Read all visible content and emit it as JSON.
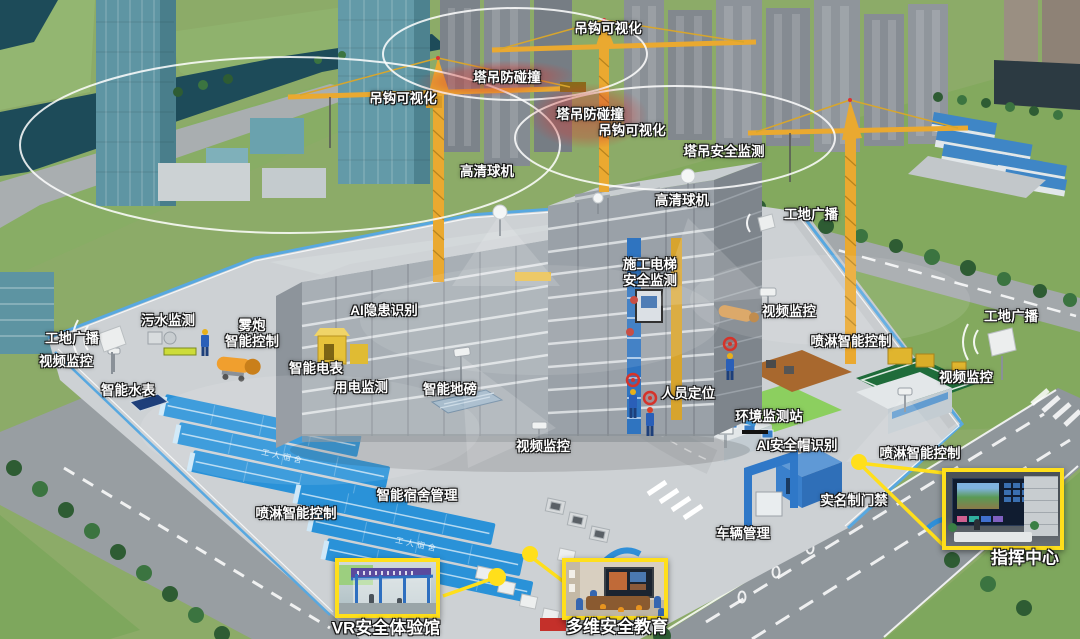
{
  "colors": {
    "accent_yellow": "#ffdf1b",
    "label_text": "#ffffff",
    "label_outline": "#141414",
    "collision_zone_red": "#d23c34",
    "fence_blue": "#58a8e0",
    "dorm_roof_blue": "#2a92d8",
    "crane_yellow": "#eaa930",
    "grass_green": "#8cab68",
    "road_gray": "#8f969b",
    "water_teal": "#1d4b59"
  },
  "roof_text": "工人宿舍",
  "labels": [
    {
      "id": "hook-visualization-top",
      "x": 608,
      "y": 29,
      "lines": [
        "吊钩可视化"
      ]
    },
    {
      "id": "tower-crane-anti-collision-1",
      "x": 507,
      "y": 78,
      "lines": [
        "塔吊防碰撞"
      ]
    },
    {
      "id": "hook-visualization-left",
      "x": 403,
      "y": 99,
      "lines": [
        "吊钩可视化"
      ]
    },
    {
      "id": "tower-crane-anti-collision-2",
      "x": 590,
      "y": 115,
      "lines": [
        "塔吊防碰撞"
      ]
    },
    {
      "id": "hook-visualization-mid",
      "x": 632,
      "y": 131,
      "lines": [
        "吊钩可视化"
      ]
    },
    {
      "id": "tower-crane-safety-monitoring",
      "x": 724,
      "y": 152,
      "lines": [
        "塔吊安全监测"
      ]
    },
    {
      "id": "hd-dome-camera-1",
      "x": 487,
      "y": 172,
      "lines": [
        "高清球机"
      ]
    },
    {
      "id": "hd-dome-camera-2",
      "x": 682,
      "y": 201,
      "lines": [
        "高清球机"
      ]
    },
    {
      "id": "site-broadcast-ne",
      "x": 811,
      "y": 215,
      "lines": [
        "工地广播"
      ]
    },
    {
      "id": "hoist-safety-monitoring",
      "x": 650,
      "y": 273,
      "lines": [
        "施工电梯",
        "安全监测"
      ]
    },
    {
      "id": "video-surveillance-ne",
      "x": 789,
      "y": 312,
      "lines": [
        "视频监控"
      ]
    },
    {
      "id": "site-broadcast-e",
      "x": 1011,
      "y": 317,
      "lines": [
        "工地广播"
      ]
    },
    {
      "id": "spray-smart-control-ne",
      "x": 851,
      "y": 342,
      "lines": [
        "喷淋智能控制"
      ]
    },
    {
      "id": "video-surveillance-e",
      "x": 966,
      "y": 378,
      "lines": [
        "视频监控"
      ]
    },
    {
      "id": "sewage-monitoring",
      "x": 168,
      "y": 321,
      "lines": [
        "污水监测"
      ]
    },
    {
      "id": "site-broadcast-w",
      "x": 72,
      "y": 339,
      "lines": [
        "工地广播"
      ]
    },
    {
      "id": "video-surveillance-w",
      "x": 66,
      "y": 362,
      "lines": [
        "视频监控"
      ]
    },
    {
      "id": "fog-cannon-smart-control",
      "x": 252,
      "y": 334,
      "lines": [
        "雾炮",
        "智能控制"
      ]
    },
    {
      "id": "ai-hazard-recognition",
      "x": 384,
      "y": 311,
      "lines": [
        "AI隐患识别"
      ]
    },
    {
      "id": "smart-electric-meter",
      "x": 316,
      "y": 369,
      "lines": [
        "智能电表"
      ]
    },
    {
      "id": "electricity-monitoring",
      "x": 361,
      "y": 388,
      "lines": [
        "用电监测"
      ]
    },
    {
      "id": "smart-water-meter",
      "x": 128,
      "y": 391,
      "lines": [
        "智能水表"
      ]
    },
    {
      "id": "smart-weighbridge",
      "x": 450,
      "y": 390,
      "lines": [
        "智能地磅"
      ]
    },
    {
      "id": "personnel-positioning",
      "x": 688,
      "y": 394,
      "lines": [
        "人员定位"
      ]
    },
    {
      "id": "environment-monitoring-station",
      "x": 769,
      "y": 417,
      "lines": [
        "环境监测站"
      ]
    },
    {
      "id": "ai-helmet-recognition",
      "x": 797,
      "y": 446,
      "lines": [
        "AI安全帽识别"
      ]
    },
    {
      "id": "spray-smart-control-e",
      "x": 920,
      "y": 454,
      "lines": [
        "喷淋智能控制"
      ]
    },
    {
      "id": "real-name-access-control",
      "x": 854,
      "y": 501,
      "lines": [
        "实名制门禁"
      ]
    },
    {
      "id": "video-surveillance-s",
      "x": 543,
      "y": 447,
      "lines": [
        "视频监控"
      ]
    },
    {
      "id": "smart-dormitory-management",
      "x": 417,
      "y": 496,
      "lines": [
        "智能宿舍管理"
      ]
    },
    {
      "id": "spray-smart-control-sw",
      "x": 296,
      "y": 514,
      "lines": [
        "喷淋智能控制"
      ]
    },
    {
      "id": "vehicle-management",
      "x": 743,
      "y": 534,
      "lines": [
        "车辆管理"
      ]
    }
  ],
  "insets": [
    {
      "id": "vr-safety-experience-hall",
      "caption": "VR安全体验馆",
      "box": {
        "x": 335,
        "y": 558,
        "w": 105,
        "h": 60
      },
      "caption_pos": {
        "x": 386,
        "y": 626
      }
    },
    {
      "id": "multi-dimension-safety-education",
      "caption": "多维安全教育",
      "box": {
        "x": 562,
        "y": 558,
        "w": 106,
        "h": 62
      },
      "caption_pos": {
        "x": 617,
        "y": 625
      }
    },
    {
      "id": "command-center",
      "caption": "指挥中心",
      "box": {
        "x": 942,
        "y": 468,
        "w": 122,
        "h": 82
      },
      "caption_pos": {
        "x": 1025,
        "y": 556
      }
    }
  ]
}
